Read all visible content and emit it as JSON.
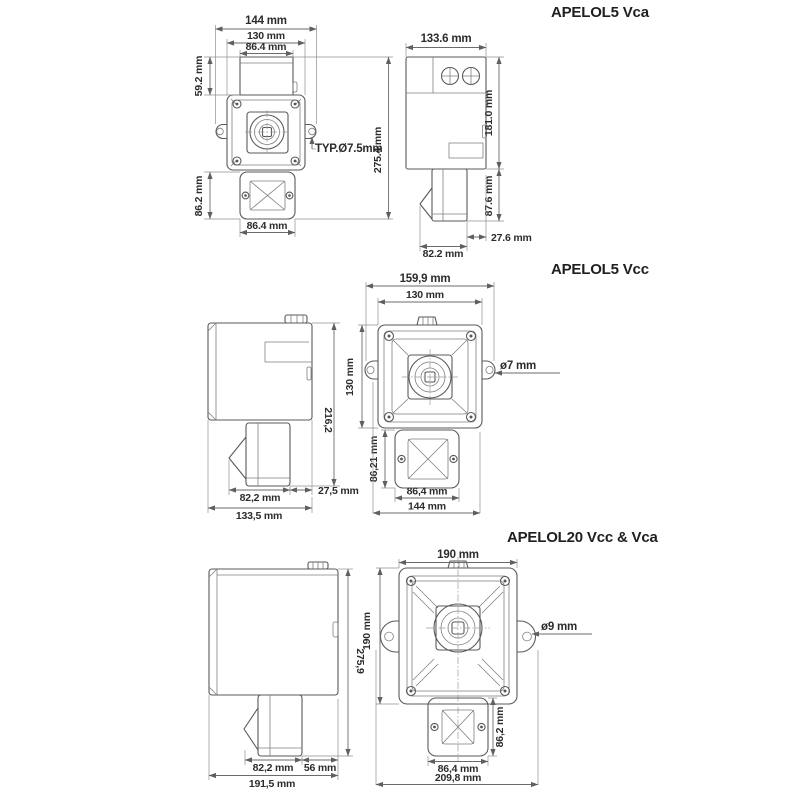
{
  "sections": [
    {
      "title": "APELOL5 Vca",
      "front_view": {
        "width_overall": "144 mm",
        "width_fixing": "130 mm",
        "width_top": "86.4 mm",
        "height_top": "59.2 mm",
        "height_overall": "275.4 mm",
        "hole_note": "TYP.Ø7.5mm",
        "height_horn": "86.2 mm",
        "width_horn": "86.4 mm"
      },
      "side_view": {
        "width_overall": "133.6 mm",
        "height_body": "181.0 mm",
        "height_horn": "87.6 mm",
        "offset": "27.6 mm",
        "width_horn": "82.2 mm"
      }
    },
    {
      "title": "APELOL5 Vcc",
      "side_view": {
        "height_overall": "216,2",
        "width_horn": "82,2 mm",
        "offset": "27,5 mm",
        "width_overall": "133,5 mm"
      },
      "front_view": {
        "width_overall": "159,9 mm",
        "width_fixing": "130 mm",
        "height_fixing": "130 mm",
        "hole_note": "ø7 mm",
        "height_horn": "86,21 mm",
        "width_horn": "86,4 mm",
        "width_base": "144 mm"
      }
    },
    {
      "title": "APELOL20 Vcc & Vca",
      "side_view": {
        "height_overall": "275,9",
        "width_horn": "82,2 mm",
        "offset": "56 mm",
        "width_overall": "191,5 mm"
      },
      "front_view": {
        "width_overall": "190 mm",
        "height_overall": "190 mm",
        "hole_note": "ø9 mm",
        "height_horn": "86,2 mm",
        "width_horn": "86,4 mm",
        "width_base": "209,8 mm"
      }
    }
  ]
}
